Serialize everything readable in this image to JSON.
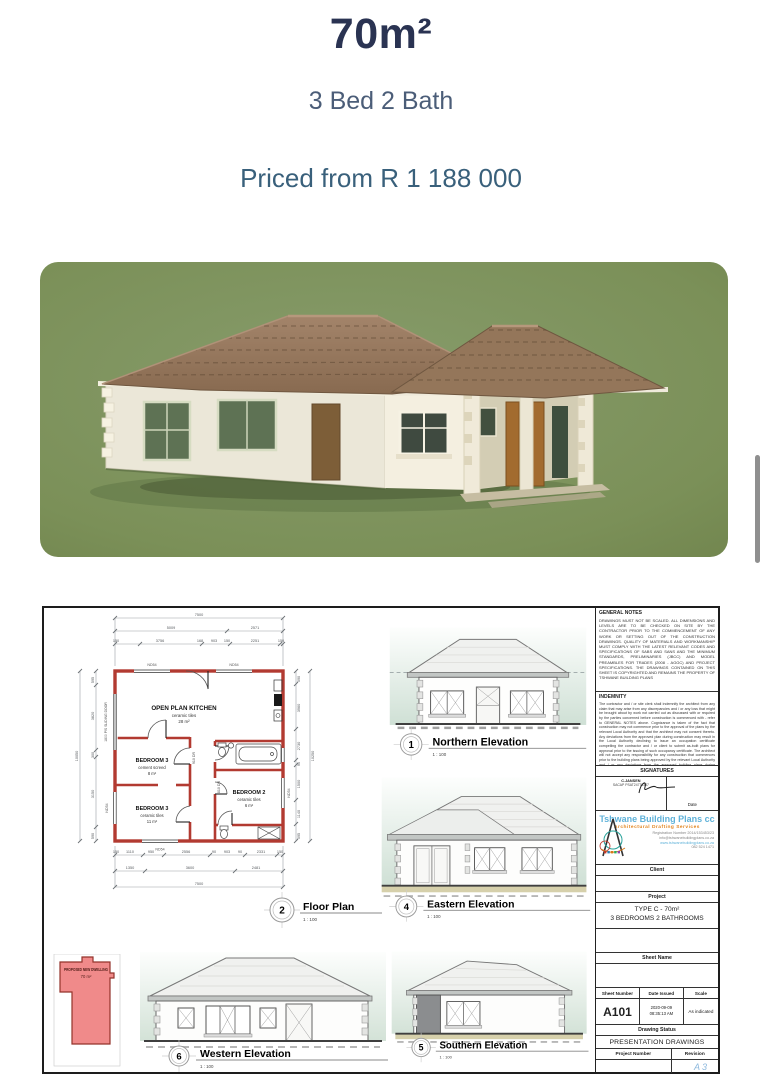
{
  "header": {
    "title": "70m²",
    "subtitle": "3 Bed 2 Bath",
    "price": "Priced from R 1 188 000"
  },
  "sheet": {
    "floor_plan": {
      "number": "2",
      "label": "Floor Plan",
      "scale": "1 : 100",
      "rooms": {
        "kitchen": {
          "name": "OPEN PLAN KITCHEN",
          "finish": "ceramic tiles",
          "area": "28 m²"
        },
        "bed3a": {
          "name": "BEDROOM 3",
          "finish": "cement screed",
          "area": "8 m²"
        },
        "bed3b": {
          "name": "BEDROOM 3",
          "finish": "ceramic tiles",
          "area": "11 m²"
        },
        "bed2": {
          "name": "BEDROOM 2",
          "finish": "ceramic tiles",
          "area": "6 m²"
        }
      },
      "sliding_door_label": "1800 P/S SLIDING DOOR",
      "window_label": "ND54",
      "door_label_1": "910 DR",
      "door_label_2": "810 DR",
      "dims": {
        "top_total": "7500",
        "top_mid": [
          "5009",
          "2571"
        ],
        "top_inner": [
          "150",
          "3756",
          "168",
          "903",
          "150",
          "2251",
          "150"
        ],
        "bottom_inner": [
          "150",
          "1110",
          "950",
          "2556",
          "90",
          "903",
          "90",
          "2331",
          "150"
        ],
        "bottom_mid": [
          "1350",
          "3600",
          "2481"
        ],
        "bottom_total": "7500",
        "left_inner": [
          "595",
          "3820",
          "300",
          "3150",
          "590"
        ],
        "left_total": "10050",
        "right_inner": [
          "590",
          "3960",
          "2730",
          "90",
          "1500",
          "1140",
          "595"
        ],
        "right_total": "10250"
      }
    },
    "elevations": [
      {
        "number": "1",
        "label": "Northern Elevation",
        "scale": "1 : 100"
      },
      {
        "number": "4",
        "label": "Eastern Elevation",
        "scale": "1 : 100"
      },
      {
        "number": "6",
        "label": "Western Elevation",
        "scale": "1 : 100"
      },
      {
        "number": "5",
        "label": "Southern Elevation",
        "scale": "1 : 100"
      }
    ],
    "site": {
      "title": "PROPOSED NEW DWELLING",
      "area": "70 m²"
    },
    "titleblock": {
      "general_notes_title": "GENERAL NOTES",
      "general_notes": "DRAWINGS MUST NOT BE SCALED. ALL DIMENSIONS AND LEVELS ARE TO BE CHECKED ON SITE BY THE CONTRACTOR PRIOR TO THE COMMENCEMENT OF ANY WORK OR SETTING OUT OF THE CONSTRUCTION DRAWINGS. QUALITY OF MATERIALS AND WORKMANSHIP MUST COMPLY WITH THE LATEST RELEVANT CODES AND SPECIFICATIONS OF SABS AND SANS AND THE MINIMUM STANDARDS, PRELIMINARIES (JBCC) AND MODEL PREAMBLES FOR TRADES (2008 - AGGC) AND PROJECT SPECIFICATIONS. THE DRAWINGS CONTAINED ON THIS SHEET IS COPYRIGHTED AND REMAINS THE PROPERTY OF TSHWANE BUILDING PLANS",
      "indemnity_title": "INDEMNITY",
      "indemnity": "The contractor and / or site clerk shall indemnify the architect from any claim that may arise from any discrepancies and / or any loss that might be brought about by work not carried out as discussed with or required by the parties concerned before construction is commenced with - refer to GENERAL NOTES above. Cognizance is taken of the fact that construction may not commence prior to the approval of the plans by the relevant Local Authority and that the architect may not consent thereto. Any deviations from the approved plan during construction may result in the Local Authority declining to issue an occupation certificate compelling the contractor and / or client to submit as-built plans for approval prior to the issuing of such occupancy certificate. The architect will not accept any responsibility for any construction that commences prior to the building plans being approved by the relevant Local Authority and / or any deviations from the approved building plans during construction",
      "signatures_title": "SIGNATURES",
      "signer_name": "C.JANSEN",
      "signer_reg": "SACAP PSAT24776387",
      "signature_date_label": "Date",
      "company": "Tshwane Building Plans cc",
      "company_sub": "Architectural Drafting Services",
      "company_line_1": "Registration Number 2014/153453/23",
      "company_line_2": "info@tshwanebuildingplans.co.za",
      "company_line_3": "www.tshwanebuildingplans.co.za",
      "company_line_4": "082 524 1471",
      "client_label": "Client",
      "project_label": "Project",
      "project_name_1": "TYPE C - 70m²",
      "project_name_2": "3 BEDROOMS 2 BATHROOMS",
      "sheet_name_label": "Sheet Name",
      "sheet_number_label": "Sheet Number",
      "sheet_number": "A101",
      "date_label": "Date Issued",
      "date_line_1": "2020-09-09",
      "date_line_2": "08:35:13 AM",
      "scale_label": "Scale",
      "scale_value": "As indicated",
      "status_label": "Drawing Status",
      "status_value": "PRESENTATION DRAWINGS",
      "project_number_label": "Project Number",
      "revision_label": "Revision"
    }
  },
  "footer": {
    "corner_mark": "A3"
  }
}
